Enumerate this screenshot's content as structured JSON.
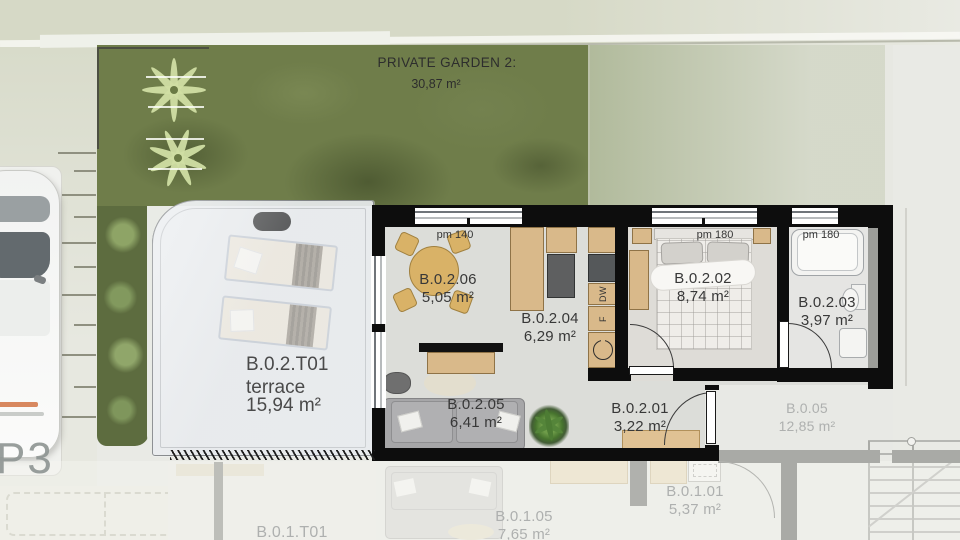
{
  "garden": {
    "title": "PRIVATE GARDEN 2:",
    "area": "30,87 m²"
  },
  "parking": {
    "space": "P3"
  },
  "unit": {
    "rooms": [
      {
        "id": "B.0.2.06",
        "area": "5,05 m²"
      },
      {
        "id": "B.0.2.04",
        "area": "6,29 m²"
      },
      {
        "id": "B.0.2.02",
        "area": "8,74 m²"
      },
      {
        "id": "B.0.2.03",
        "area": "3,97 m²"
      },
      {
        "id": "B.0.2.05",
        "area": "6,41 m²"
      },
      {
        "id": "B.0.2.01",
        "area": "3,22 m²"
      }
    ],
    "terrace": {
      "id": "B.0.2.T01",
      "name": "terrace",
      "area": "15,94 m²"
    },
    "window_marks": [
      "pm 140",
      "pm 180",
      "pm 180"
    ],
    "appliances": {
      "dishwasher": "DW",
      "fridge": "F"
    }
  },
  "adjacent": {
    "b005": {
      "id": "B.0.05",
      "area": "12,85 m²"
    },
    "b0101": {
      "id": "B.0.1.01",
      "area": "5,37 m²"
    },
    "b0105": {
      "id": "B.0.1.05",
      "area": "7,65 m²"
    },
    "b01t01": {
      "id": "B.0.1.T01"
    }
  },
  "colors": {
    "garden_green": "#6e7c49",
    "wall": "#0d0d0d",
    "wood": "#d9b98a",
    "label": "#383838",
    "label_faded": "#aeb0af"
  }
}
